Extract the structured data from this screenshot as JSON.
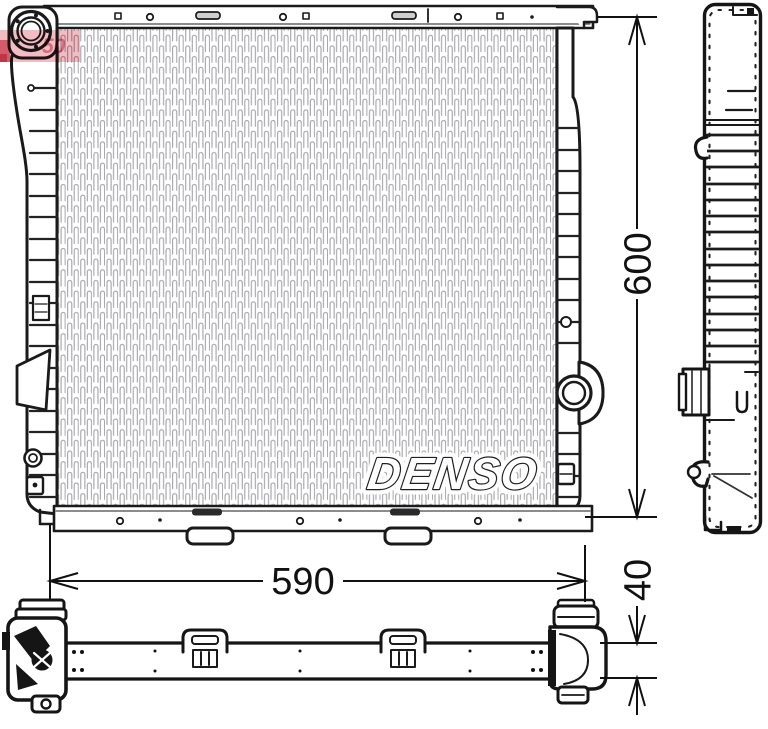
{
  "drawing": {
    "brand_logo": "DENSO",
    "dimensions": {
      "height": "600",
      "width": "590",
      "depth": "40"
    },
    "watermark_fragment": "50",
    "colors": {
      "line_art": "#1a1a1a",
      "dimension": "#111111",
      "core_fin": "#a6a6ac",
      "watermark_red": "#e2606e",
      "background": "#ffffff"
    }
  }
}
